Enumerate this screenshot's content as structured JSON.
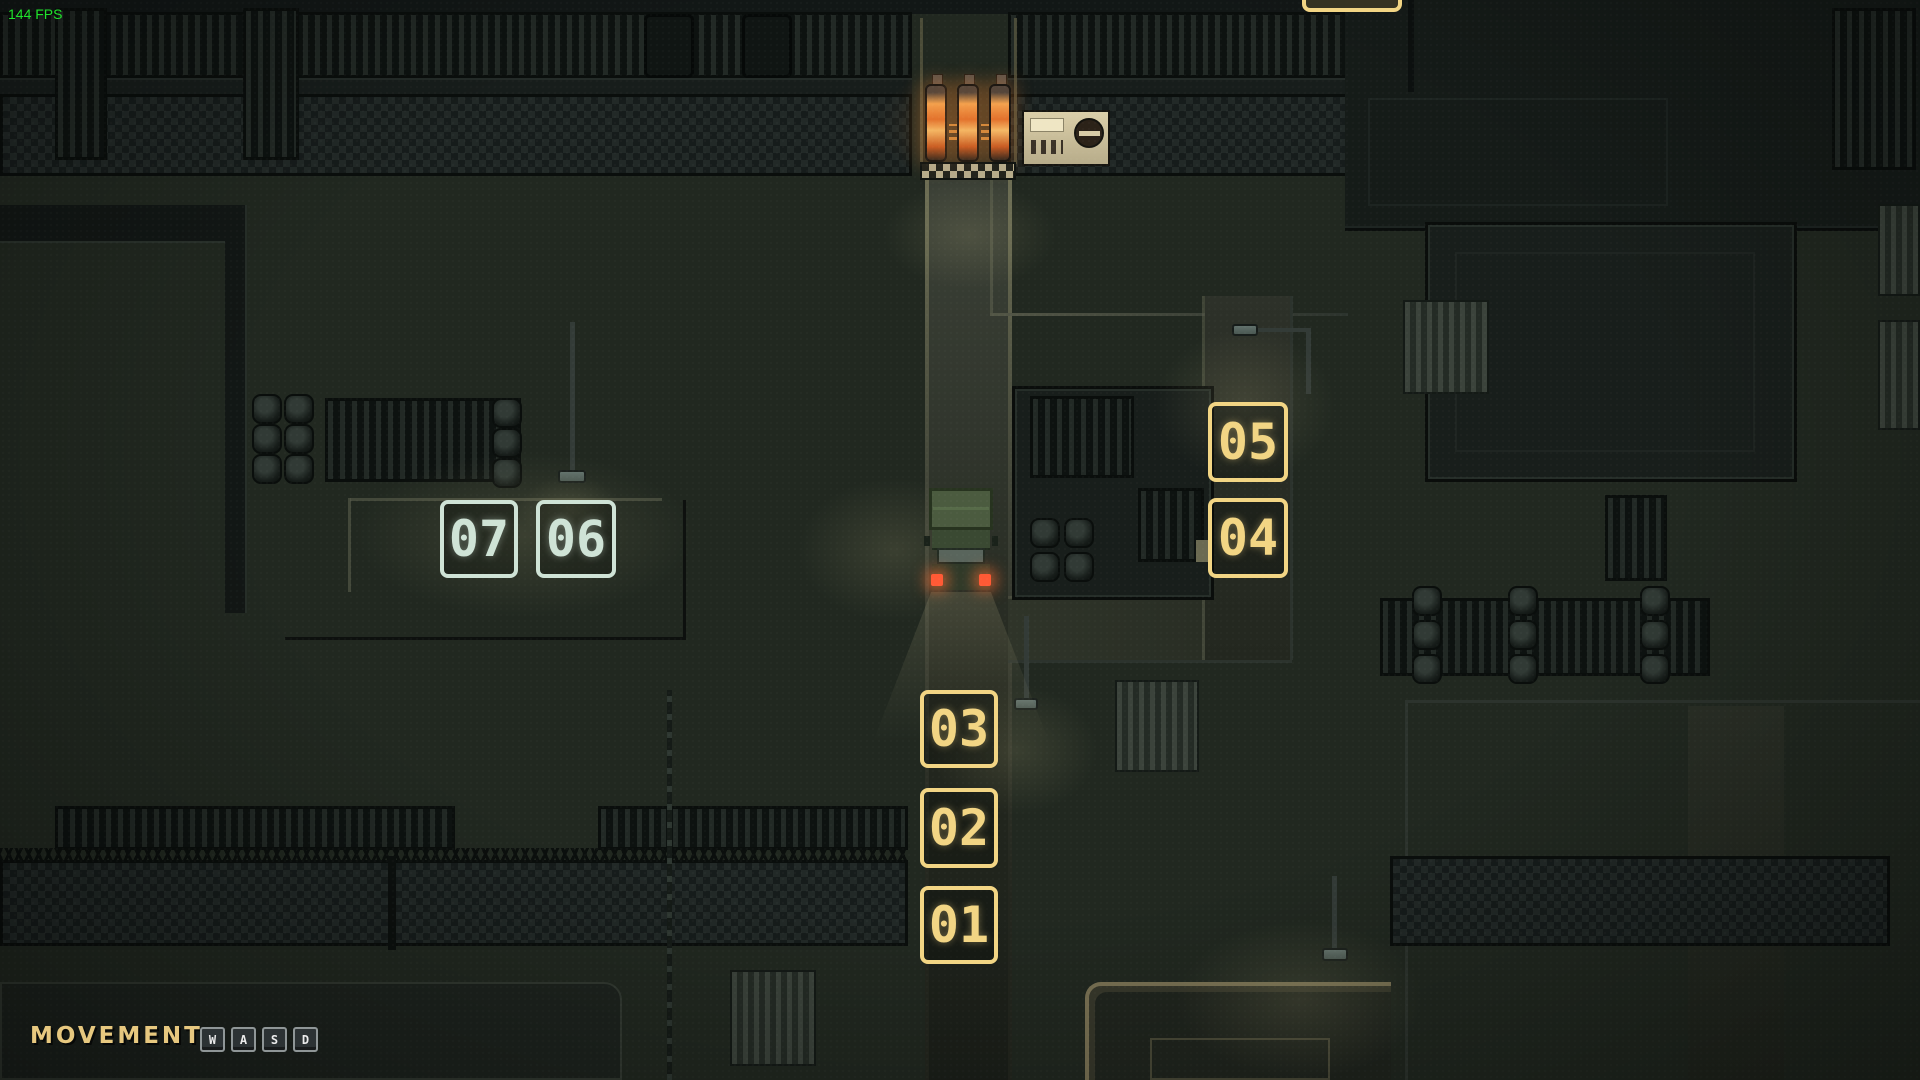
{
  "hud": {
    "fps_label": "144 FPS",
    "movement_label": "MOVEMENT",
    "keys": [
      "W",
      "A",
      "S",
      "D"
    ]
  },
  "markers": {
    "items": [
      {
        "label": "01",
        "style": "yellow"
      },
      {
        "label": "02",
        "style": "yellow"
      },
      {
        "label": "03",
        "style": "yellow"
      },
      {
        "label": "04",
        "style": "yellow"
      },
      {
        "label": "05",
        "style": "yellow"
      },
      {
        "label": "06",
        "style": "mint"
      },
      {
        "label": "07",
        "style": "mint"
      }
    ],
    "yellow_hex": "#f2d584",
    "mint_hex": "#cfe3d6"
  },
  "colors": {
    "fps_green": "#1fe32b",
    "movement_tan": "#e7c87f",
    "furnace_orange": "#e8823a",
    "vehicle_light_red": "#ff5a35"
  }
}
